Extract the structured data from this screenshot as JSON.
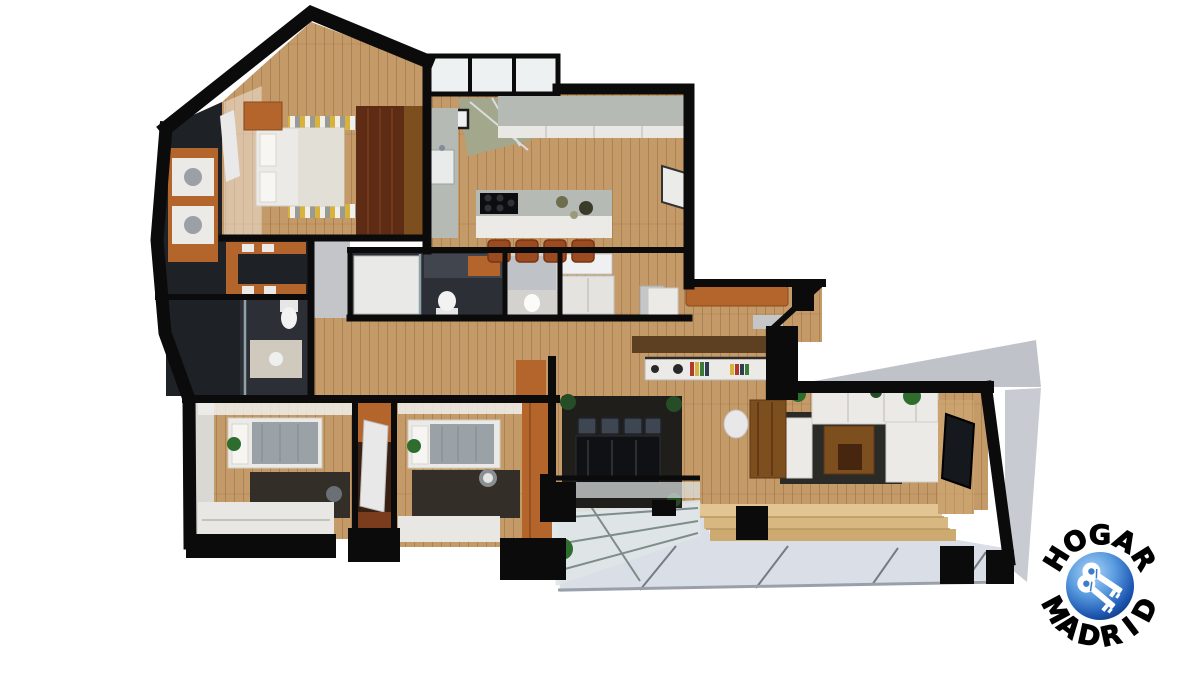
{
  "image": {
    "kind": "3d-floor-plan-render",
    "view": "top-down dollhouse cutaway of an apartment",
    "background": "#ffffff"
  },
  "logo": {
    "top_text": "HOGAR",
    "bottom_text": "MADRID",
    "emblem": "blue-globe-with-two-white-keys"
  },
  "palette": {
    "wood": "#c49a68",
    "wood_light": "#ddbe92",
    "wall": "#0b0b0b",
    "tile": "#2c3036",
    "tile_dark": "#1e2126",
    "marble": "#b5bab4",
    "white_furn": "#eceae6",
    "orange": "#b4652b",
    "orange_deep": "#9c4a1f",
    "dark_wood": "#5e2c14",
    "mid_wood": "#7d4e1e",
    "rug": "#2a2a26",
    "rug_dark": "#1f1e1b",
    "gray_wall": "#c3c5c9",
    "glass": "#dfe5e6",
    "terrace": "#dadee7",
    "deck": "#ddbe92",
    "canopy": "#b6c2bf",
    "green": "#2f6d2f",
    "beam": "#5d3f22",
    "blanket": "#9aa1a7",
    "book_red": "#b03a2e",
    "book_yellow": "#d9b23c",
    "book_green": "#3c7a3c",
    "logo_text": "#000000",
    "logo_blue": "#1c55b0",
    "logo_blue_light": "#8ec1f2"
  },
  "rooms": [
    {
      "name": "master-bedroom",
      "features": [
        "double-bed",
        "dark-wood-wardrobe",
        "striped-rug",
        "dresser"
      ]
    },
    {
      "name": "walk-in-closet",
      "features": [
        "orange-shelving"
      ]
    },
    {
      "name": "utility-room",
      "features": [
        "stacked-appliances",
        "orange-cabinet"
      ]
    },
    {
      "name": "bathroom-main",
      "features": [
        "shower",
        "toilet",
        "vanity"
      ]
    },
    {
      "name": "bathroom-secondary",
      "features": [
        "walk-in-shower",
        "toilet",
        "vanity"
      ]
    },
    {
      "name": "kitchen",
      "features": [
        "island-with-hob",
        "four-stools",
        "marble-counters",
        "bay-window",
        "green-patio"
      ]
    },
    {
      "name": "entry-hall",
      "features": [
        "orange-bench",
        "sideboard-with-books",
        "entry-door"
      ]
    },
    {
      "name": "bedroom-2",
      "features": [
        "single-bed",
        "desk",
        "balcony"
      ]
    },
    {
      "name": "bedroom-3",
      "features": [
        "single-bed",
        "desk-chair",
        "orange-wardrobe",
        "balcony"
      ]
    },
    {
      "name": "dining-area",
      "features": [
        "dark-table",
        "four-chairs",
        "dark-rug",
        "plants"
      ]
    },
    {
      "name": "living-room",
      "features": [
        "white-sofa-set",
        "coffee-table",
        "tv-panel",
        "desk",
        "plants"
      ]
    },
    {
      "name": "terrace",
      "features": [
        "wood-steps",
        "glass-canopy",
        "glass-balustrade",
        "plant"
      ]
    }
  ]
}
